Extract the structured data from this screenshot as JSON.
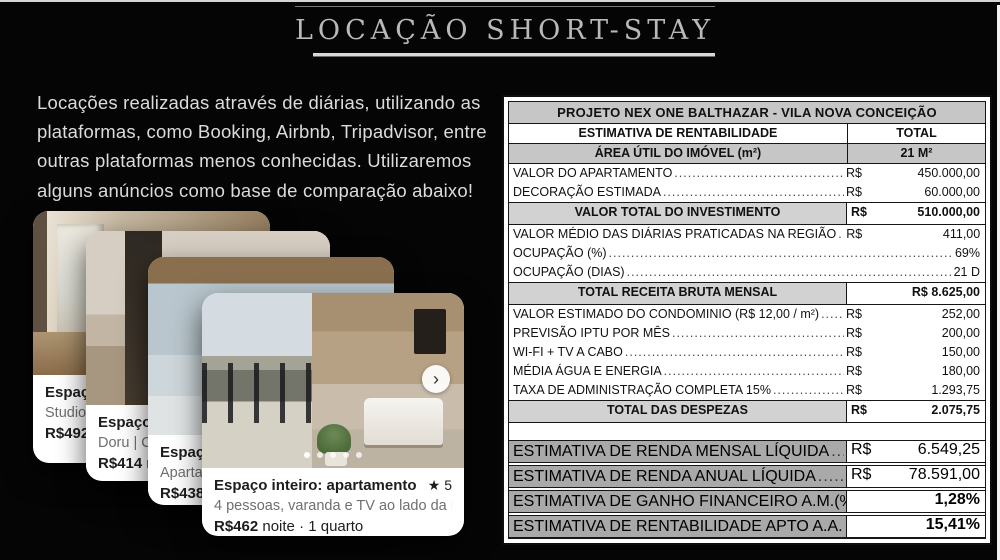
{
  "slide": {
    "title": "LOCAÇÃO SHORT-STAY"
  },
  "intro": "Locações realizadas através de diárias, utilizando as plataformas, como Booking, Airbnb, Tripadvisor, entre outras plataformas menos conhecidas. Utilizaremos alguns anúncios como base de comparação abaixo!",
  "icons": {
    "star": "★",
    "chevron_right": "›"
  },
  "cards": [
    {
      "title": "Espaço",
      "subtitle": "Studio It",
      "price_bold": "R$492",
      "price_rest": " n"
    },
    {
      "title": "Espaço",
      "subtitle": "Doru | C",
      "price_bold": "R$414",
      "price_rest": " n"
    },
    {
      "title": "Espaço i",
      "subtitle": "Apartam",
      "price_bold": "R$438",
      "price_rest": " no"
    },
    {
      "title": "Espaço inteiro: apartamento em Sã...",
      "rating": "5",
      "subtitle": "4 pessoas, varanda e TV ao lado da Faria...",
      "price_bold": "R$462",
      "price_rest": " noite · 1 quarto"
    }
  ],
  "table": {
    "title": "PROJETO NEX ONE BALTHAZAR - VILA NOVA CONCEIÇÃO",
    "head": {
      "label": "ESTIMATIVA DE RENTABILIDADE",
      "value": "TOTAL"
    },
    "area": {
      "label": "ÁREA ÚTIL DO IMÓVEL (m²)",
      "value": "21 M²"
    },
    "rows": [
      {
        "label": "VALOR DO APARTAMENTO",
        "cur": "R$",
        "value": "450.000,00"
      },
      {
        "label": "DECORAÇÃO ESTIMADA",
        "cur": "R$",
        "value": "60.000,00"
      },
      {
        "label": "VALOR TOTAL DO INVESTIMENTO",
        "cur": "R$",
        "value": "510.000,00"
      },
      {
        "label": "VALOR MÉDIO DAS DIÁRIAS PRATICADAS NA REGIÃO",
        "cur": "R$",
        "value": "411,00"
      },
      {
        "label": "OCUPAÇÃO (%)",
        "value": "69%"
      },
      {
        "label": "OCUPAÇÃO (DIAS)",
        "value": "21 D"
      },
      {
        "label": "TOTAL RECEITA BRUTA MENSAL",
        "value": "R$ 8.625,00"
      },
      {
        "label": "VALOR ESTIMADO DO CONDOMINIO (R$ 12,00 / m²)",
        "cur": "R$",
        "value": "252,00"
      },
      {
        "label": "PREVISÃO IPTU POR MÊS",
        "cur": "R$",
        "value": "200,00"
      },
      {
        "label": "WI-FI + TV A CABO",
        "cur": "R$",
        "value": "150,00"
      },
      {
        "label": "MÉDIA ÁGUA E ENERGIA",
        "cur": "R$",
        "value": "180,00"
      },
      {
        "label": "TAXA DE ADMINISTRAÇÃO COMPLETA 15%",
        "cur": "R$",
        "value": "1.293,75"
      },
      {
        "label": "TOTAL DAS DESPEZAS",
        "cur": "R$",
        "value": "2.075,75"
      }
    ],
    "results": [
      {
        "label": "ESTIMATIVA DE RENDA MENSAL LÍQUIDA",
        "cur": "R$",
        "value": "6.549,25"
      },
      {
        "label": "ESTIMATIVA DE RENDA ANUAL LÍQUIDA",
        "cur": "R$",
        "value": "78.591,00"
      },
      {
        "label": "ESTIMATIVA DE GANHO FINANCEIRO A.M.(%)",
        "value": "1,28%"
      },
      {
        "label": "ESTIMATIVA DE RENTABILIDADE APTO A.A. (%)",
        "value": "15,41%"
      }
    ]
  },
  "colors": {
    "slide_bg": "#050505",
    "table_header_gray": "#c6c6c6",
    "result_label_gray": "#a9a9a9",
    "title_text": "#b9b9b9"
  }
}
